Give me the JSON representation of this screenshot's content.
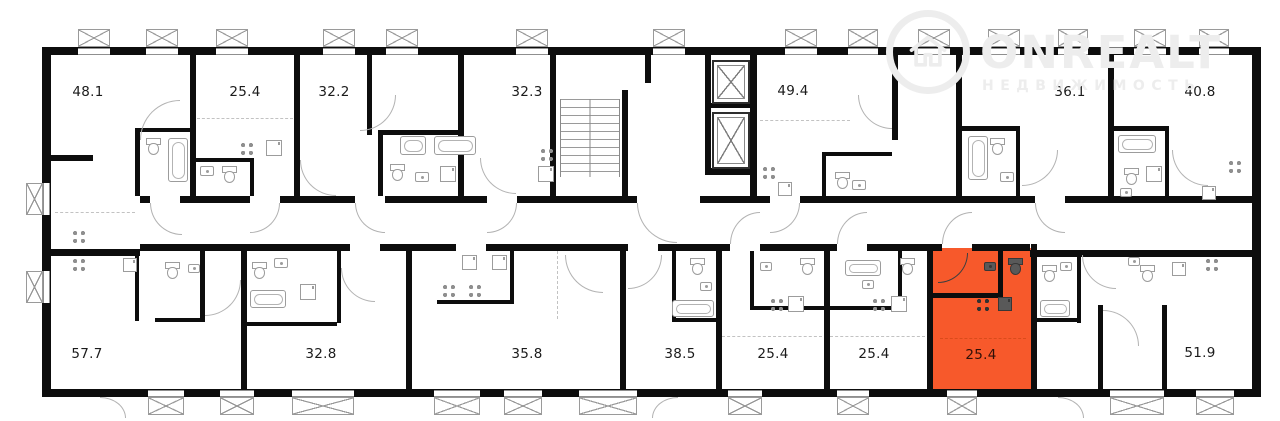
{
  "watermark": {
    "brand": "ONREALT",
    "subtitle": "НЕДВИЖИМОСТЬ"
  },
  "colors": {
    "highlight_fill": "#F7592B",
    "wall": "#0d0d0d",
    "fixture_stroke": "#9c9c9c",
    "watermark_gray": "#ededed"
  },
  "apartments": {
    "top_row": [
      {
        "area": "48.1"
      },
      {
        "area": "25.4"
      },
      {
        "area": "32.2"
      },
      {
        "area": "32.3"
      },
      {
        "area": "49.4"
      },
      {
        "area": "36.1"
      },
      {
        "area": "40.8"
      }
    ],
    "bottom_row": [
      {
        "area": "57.7"
      },
      {
        "area": "32.8"
      },
      {
        "area": "35.8"
      },
      {
        "area": "38.5"
      },
      {
        "area": "25.4"
      },
      {
        "area": "25.4"
      },
      {
        "area": "25.4"
      },
      {
        "area": "51.9"
      }
    ]
  },
  "highlighted_apartment": {
    "area": "25.4",
    "row": "bottom_row",
    "index": 6
  },
  "icons": [
    "balcony-icon",
    "window-icon",
    "elevator-icon",
    "stairs-icon",
    "bathtub-icon",
    "toilet-icon",
    "sink-icon",
    "stove-icon",
    "appliance-icon",
    "door-arc-icon",
    "house-logo-icon"
  ]
}
